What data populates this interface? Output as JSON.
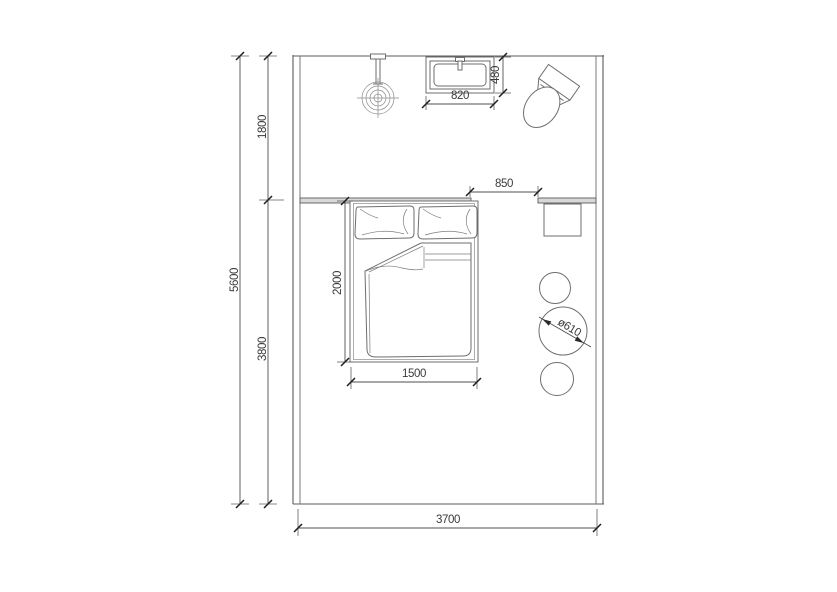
{
  "drawing": {
    "type": "architectural floor plan",
    "subject": "bedroom with bathroom zone, bed, wash basin, toilet, side table and stools"
  },
  "colors": {
    "background": "#ffffff",
    "wall_line": "#5b5b5b",
    "dimension_line": "#4f4f4f",
    "dimension_text": "#3a3a3a",
    "partition_fill": "#d8d8d8"
  },
  "dimensions": {
    "room_height_total": "5600",
    "bath_zone_depth": "1800",
    "bedroom_zone_depth": "3800",
    "bed_length": "2000",
    "bed_width": "1500",
    "room_width": "3700",
    "basin_width": "820",
    "basin_depth": "480",
    "opening_width": "850",
    "stool_diameter": "ø610"
  },
  "symbols": [
    {
      "name": "pendant-light-icon",
      "meaning": "ceiling light on wall stem"
    },
    {
      "name": "wash-basin-icon",
      "meaning": "rectangular wash basin with tap"
    },
    {
      "name": "toilet-icon",
      "meaning": "toilet rotated against top wall"
    },
    {
      "name": "double-bed-icon",
      "meaning": "bed with two pillows and folded duvet"
    },
    {
      "name": "side-table-icon",
      "meaning": "square side table"
    },
    {
      "name": "stool-icon",
      "meaning": "round stool, three in a column"
    }
  ]
}
